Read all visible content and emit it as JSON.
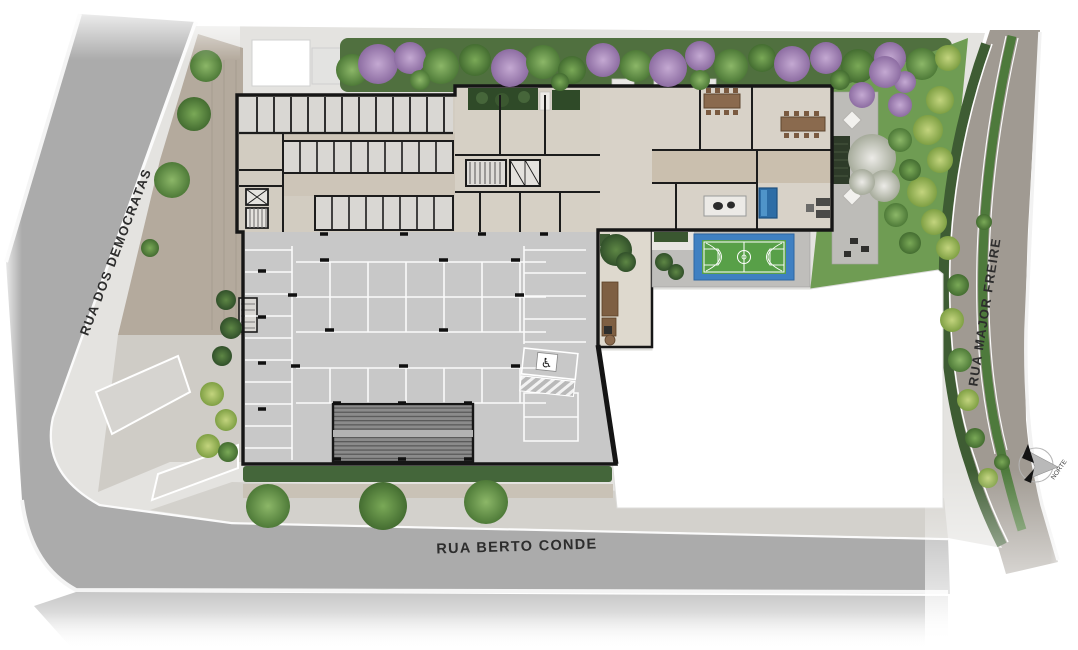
{
  "labels": {
    "street_left": "RUA DOS DEMOCRATAS",
    "street_bottom": "RUA BERTO CONDE",
    "street_right": "RUA MAJOR FREIRE",
    "north": "NORTE"
  },
  "icons": {
    "accessible_parking": "♿",
    "north_arrow": "compass-rose"
  },
  "colors": {
    "street": "#ababab",
    "street_right": "#a09a92",
    "curb": "#ffffff",
    "sidewalk": "#e4e3e0",
    "entry_pavers": "#b4aa9d",
    "building_wall": "#161616",
    "floor_beige": "#d6d0c5",
    "garage_gray": "#c8c8c8",
    "stall_line": "#fbfbfb",
    "slat_roof": "#8b8b8b",
    "hedge_green": "#3e5c33",
    "garden_green": "#6f9c53",
    "court_blue": "#3f80c2",
    "court_green": "#58a048",
    "pool_blue": "#2d6da6",
    "wood_deck": "#7e5f42",
    "tree_green": "#6d9c50",
    "tree_purple": "#a588b8",
    "tree_yellow": "#a9c266",
    "empty_lot": "#ffffff"
  }
}
